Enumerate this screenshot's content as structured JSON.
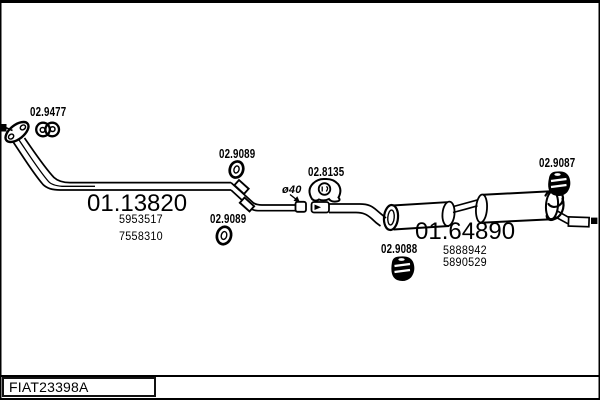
{
  "diagram": {
    "vehicle_code": "FIAT23398A",
    "assemblies": [
      {
        "part_number": "01.13820",
        "oe_numbers": [
          "5953517",
          "7558310"
        ]
      },
      {
        "part_number": "01.64890",
        "oe_numbers": [
          "5888942",
          "5890529"
        ]
      }
    ],
    "fittings": [
      {
        "part_number": "02.9477",
        "icon": "double-ring-clamp"
      },
      {
        "part_number": "02.9089",
        "icon": "oval-ring-gasket"
      },
      {
        "part_number": "02.9089",
        "icon": "oval-ring-gasket"
      },
      {
        "part_number": "02.8135",
        "icon": "mount-bracket"
      },
      {
        "part_number": "02.9088",
        "icon": "rubber-mount"
      },
      {
        "part_number": "02.9087",
        "icon": "rubber-mount"
      }
    ],
    "dimension_note": "ø40",
    "colors": {
      "ink": "#000000",
      "paper": "#ffffff"
    }
  },
  "labels": {
    "clamp_front": "02.9477",
    "front_pipe_assembly": "01.13820",
    "front_pipe_oe_1": "5953517",
    "front_pipe_oe_2": "7558310",
    "gasket_upper": "02.9089",
    "gasket_lower": "02.9089",
    "pipe_diameter": "ø40",
    "bracket_mid": "02.8135",
    "mount_mid": "02.9088",
    "rear_assembly": "01.64890",
    "rear_oe_1": "5888942",
    "rear_oe_2": "5890529",
    "mount_rear": "02.9087",
    "drawing_code": "FIAT23398A"
  }
}
